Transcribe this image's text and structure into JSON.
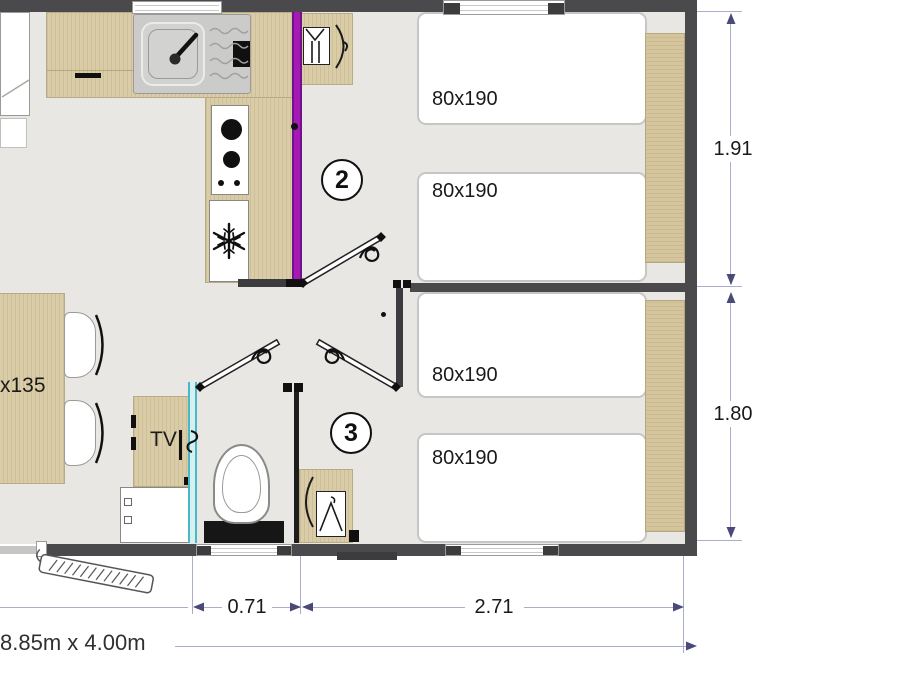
{
  "plan_footer": {
    "overall_size": "8.85m x 4.00m"
  },
  "rooms": {
    "room2_number": "2",
    "room3_number": "3"
  },
  "furniture_labels": {
    "tv": "TV",
    "table_size": "x135"
  },
  "beds": [
    {
      "label": "80x190"
    },
    {
      "label": "80x190"
    },
    {
      "label": "80x190"
    },
    {
      "label": "80x190"
    }
  ],
  "dimensions": {
    "right_top": "1.91",
    "right_bottom": "1.80",
    "bottom_left": "0.71",
    "bottom_right": "2.71"
  },
  "icons": {
    "snowflake": "❄",
    "clothes_hanger": "hanger",
    "faucet": "tap",
    "entrance_steps": "steps"
  },
  "colors": {
    "wall": "#4a4a4c",
    "floor": "#e8e7e4",
    "wood": "#d9cca6",
    "wood_dark": "#d4c59c",
    "accent_purple": "#a519b4",
    "accent_cyan": "#49b8c6",
    "dimension_line": "#a9aecd",
    "dimension_arrow": "#4a4a7a",
    "text": "#1a1a1a"
  }
}
